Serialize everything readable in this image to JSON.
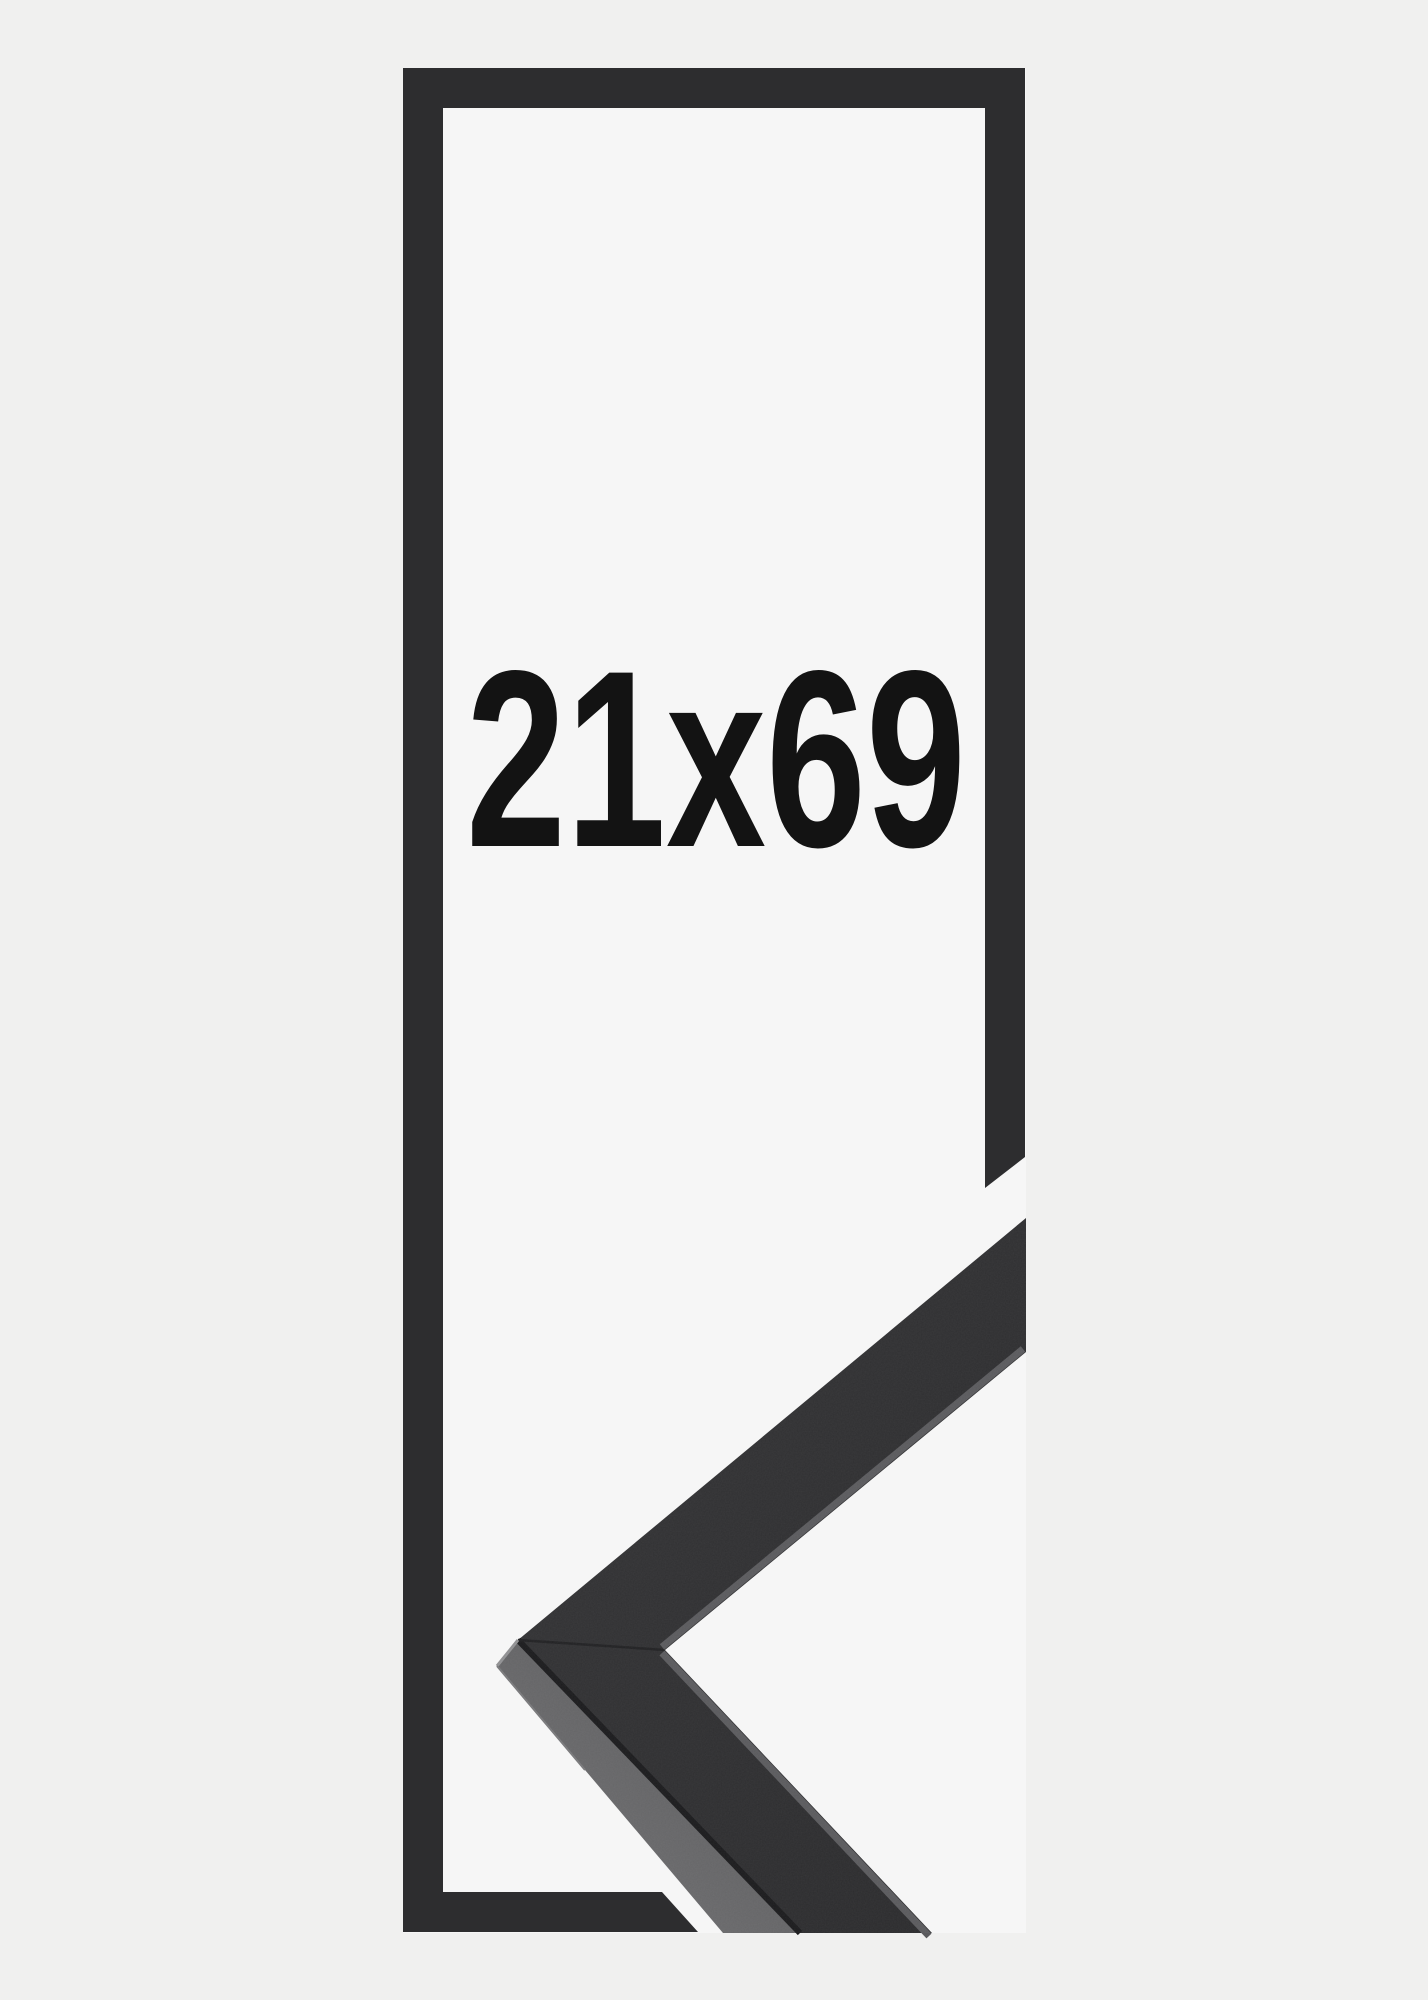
{
  "product_image": {
    "size_label": "21x69",
    "colors": {
      "page_bg": "#f0f0ef",
      "photo_bg": "#f6f6f6",
      "outline": "#2d2d2f",
      "label": "#131313",
      "face_light": "#343436",
      "face_dark": "#2a2a2c",
      "band_light": "#737375",
      "band_mid": "#636365",
      "band_dark": "#48484a",
      "seam": "#212123",
      "shadow": "#1b1b1d",
      "lip": "#5a5a5d",
      "edge_highlight": "#929294",
      "edge_highlight_soft": "#7a7a7c"
    }
  }
}
